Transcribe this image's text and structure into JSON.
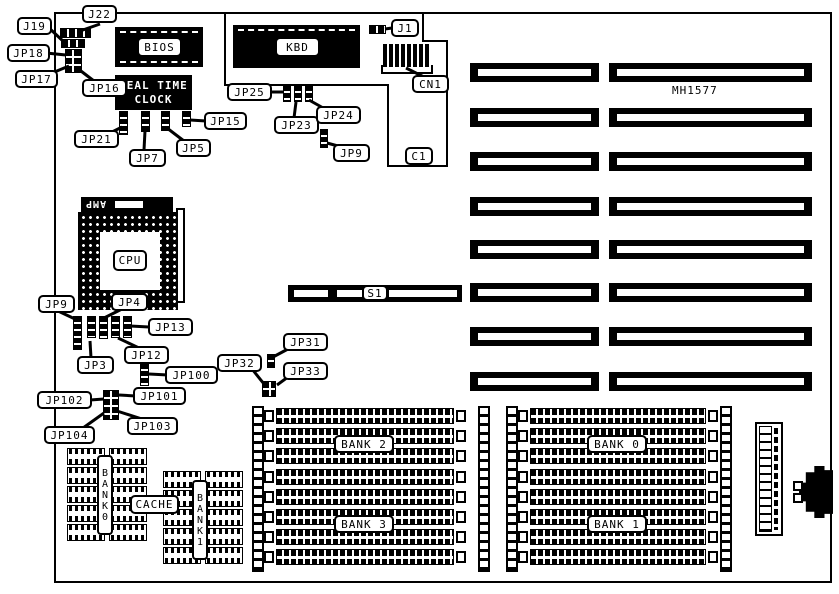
{
  "diagram": {
    "board_model": "MH1577",
    "colors": {
      "ink": "#000000",
      "paper": "#ffffff"
    },
    "chips": {
      "bios": "BIOS",
      "kbd": "KBD",
      "rtc_line1": "REAL TIME",
      "rtc_line2": "CLOCK",
      "cpu": "CPU",
      "amp": "AMP"
    },
    "labels": {
      "j22": "J22",
      "j19": "J19",
      "jp18": "JP18",
      "jp17": "JP17",
      "jp16": "JP16",
      "jp21": "JP21",
      "jp7": "JP7",
      "jp5": "JP5",
      "jp15": "JP15",
      "jp25": "JP25",
      "jp23": "JP23",
      "jp24": "JP24",
      "jp9_top": "JP9",
      "j1": "J1",
      "cn1": "CN1",
      "c1": "C1",
      "jp9_left": "JP9",
      "jp4": "JP4",
      "jp13": "JP13",
      "jp12": "JP12",
      "jp3": "JP3",
      "jp100": "JP100",
      "jp101": "JP101",
      "jp102": "JP102",
      "jp103": "JP103",
      "jp104": "JP104",
      "jp32": "JP32",
      "jp31": "JP31",
      "jp33": "JP33",
      "s1": "S1"
    },
    "memory_banks": {
      "bank0": "BANK 0",
      "bank1": "BANK 1",
      "bank2": "BANK 2",
      "bank3": "BANK 3"
    },
    "cache": {
      "label": "CACHE",
      "bank0_vertical": "BANK0",
      "bank1_vertical": "BANK1"
    }
  }
}
